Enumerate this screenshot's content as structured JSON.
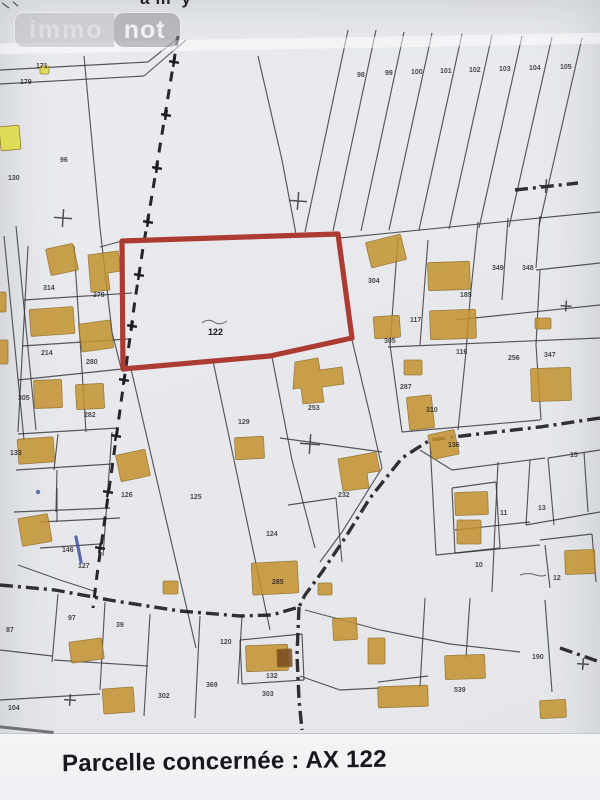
{
  "watermark": {
    "left": "immo",
    "right": "not"
  },
  "top_edge_fragments": [
    "am",
    "y"
  ],
  "caption": {
    "text": "Parcelle concernée : AX 122"
  },
  "colors": {
    "paper": "#e9ebee",
    "band": "#f3f4f5",
    "caption_color": "#17181c",
    "line": "#33343a",
    "road": "#1b1b1f",
    "building": "#c3922e",
    "building_edge": "#8f6a1d",
    "lemon": "#e0dc3f",
    "dark_building": "#7a4a1e",
    "red": "#ac3a31",
    "blue_ink": "#3f51a3"
  },
  "map": {
    "red_parcel_points": "122,241 338,234 352,338 270,356 123,369",
    "red_parcel_label": {
      "t": "122",
      "x": 208,
      "y": 335
    },
    "labels": [
      {
        "t": "171",
        "x": 36,
        "y": 68
      },
      {
        "t": "179",
        "x": 20,
        "y": 84
      },
      {
        "t": "96",
        "x": 60,
        "y": 162
      },
      {
        "t": "130",
        "x": 8,
        "y": 180
      },
      {
        "t": "98",
        "x": 357,
        "y": 77
      },
      {
        "t": "99",
        "x": 385,
        "y": 75
      },
      {
        "t": "100",
        "x": 411,
        "y": 74
      },
      {
        "t": "101",
        "x": 440,
        "y": 73
      },
      {
        "t": "102",
        "x": 469,
        "y": 72
      },
      {
        "t": "103",
        "x": 499,
        "y": 71
      },
      {
        "t": "104",
        "x": 529,
        "y": 70
      },
      {
        "t": "105",
        "x": 560,
        "y": 69
      },
      {
        "t": "304",
        "x": 368,
        "y": 283
      },
      {
        "t": "185",
        "x": 460,
        "y": 297
      },
      {
        "t": "349",
        "x": 492,
        "y": 270
      },
      {
        "t": "348",
        "x": 522,
        "y": 270
      },
      {
        "t": "117",
        "x": 410,
        "y": 322
      },
      {
        "t": "305",
        "x": 384,
        "y": 343
      },
      {
        "t": "116",
        "x": 456,
        "y": 354
      },
      {
        "t": "256",
        "x": 508,
        "y": 360
      },
      {
        "t": "347",
        "x": 544,
        "y": 357
      },
      {
        "t": "287",
        "x": 400,
        "y": 389
      },
      {
        "t": "310",
        "x": 426,
        "y": 412
      },
      {
        "t": "136",
        "x": 448,
        "y": 447
      },
      {
        "t": "314",
        "x": 43,
        "y": 290
      },
      {
        "t": "279",
        "x": 93,
        "y": 297
      },
      {
        "t": "214",
        "x": 41,
        "y": 355
      },
      {
        "t": "280",
        "x": 86,
        "y": 364
      },
      {
        "t": "305",
        "x": 18,
        "y": 400
      },
      {
        "t": "282",
        "x": 84,
        "y": 417
      },
      {
        "t": "133",
        "x": 10,
        "y": 455
      },
      {
        "t": "126",
        "x": 121,
        "y": 497
      },
      {
        "t": "125",
        "x": 190,
        "y": 499
      },
      {
        "t": "129",
        "x": 238,
        "y": 424
      },
      {
        "t": "124",
        "x": 266,
        "y": 536
      },
      {
        "t": "253",
        "x": 308,
        "y": 410
      },
      {
        "t": "232",
        "x": 338,
        "y": 497
      },
      {
        "t": "146",
        "x": 62,
        "y": 552
      },
      {
        "t": "127",
        "x": 78,
        "y": 568
      },
      {
        "t": "97",
        "x": 68,
        "y": 620
      },
      {
        "t": "39",
        "x": 116,
        "y": 627
      },
      {
        "t": "87",
        "x": 6,
        "y": 632
      },
      {
        "t": "104",
        "x": 8,
        "y": 710
      },
      {
        "t": "120",
        "x": 220,
        "y": 644
      },
      {
        "t": "285",
        "x": 272,
        "y": 584
      },
      {
        "t": "369",
        "x": 206,
        "y": 687
      },
      {
        "t": "302",
        "x": 158,
        "y": 698
      },
      {
        "t": "132",
        "x": 266,
        "y": 678
      },
      {
        "t": "303",
        "x": 262,
        "y": 696
      },
      {
        "t": "190",
        "x": 532,
        "y": 659
      },
      {
        "t": "539",
        "x": 454,
        "y": 692
      },
      {
        "t": "15",
        "x": 570,
        "y": 457
      },
      {
        "t": "13",
        "x": 538,
        "y": 510
      },
      {
        "t": "11",
        "x": 500,
        "y": 515
      },
      {
        "t": "10",
        "x": 475,
        "y": 567
      },
      {
        "t": "12",
        "x": 553,
        "y": 580
      }
    ],
    "buildings": [
      {
        "x": 0,
        "y": 126,
        "w": 20,
        "h": 24,
        "r": -5,
        "c": "lemon"
      },
      {
        "x": 40,
        "y": 66,
        "w": 9,
        "h": 8,
        "r": 0,
        "c": "lemon"
      },
      {
        "x": 48,
        "y": 246,
        "w": 28,
        "h": 27,
        "r": -12
      },
      {
        "p": "88,255 118,251 121,271 108,273 110,290 91,292"
      },
      {
        "x": 368,
        "y": 238,
        "w": 36,
        "h": 26,
        "r": -14
      },
      {
        "x": 428,
        "y": 262,
        "w": 42,
        "h": 28,
        "r": -2
      },
      {
        "x": 30,
        "y": 308,
        "w": 44,
        "h": 27,
        "r": -4
      },
      {
        "x": 80,
        "y": 322,
        "w": 32,
        "h": 28,
        "r": -8
      },
      {
        "x": 374,
        "y": 316,
        "w": 26,
        "h": 22,
        "r": -4
      },
      {
        "x": 430,
        "y": 310,
        "w": 46,
        "h": 29,
        "r": -2
      },
      {
        "x": 535,
        "y": 318,
        "w": 16,
        "h": 11,
        "r": 0
      },
      {
        "x": 34,
        "y": 380,
        "w": 28,
        "h": 28,
        "r": -2
      },
      {
        "x": 76,
        "y": 384,
        "w": 28,
        "h": 25,
        "r": -3
      },
      {
        "x": 531,
        "y": 368,
        "w": 40,
        "h": 33,
        "r": -2
      },
      {
        "p": "295,362 318,358 320,370 342,367 344,384 322,387 324,402 303,404 301,388 293,389"
      },
      {
        "x": 404,
        "y": 360,
        "w": 18,
        "h": 15,
        "r": 0
      },
      {
        "x": 408,
        "y": 396,
        "w": 25,
        "h": 33,
        "r": -6
      },
      {
        "x": 430,
        "y": 432,
        "w": 27,
        "h": 25,
        "r": -12
      },
      {
        "x": 118,
        "y": 452,
        "w": 30,
        "h": 27,
        "r": -12
      },
      {
        "x": 18,
        "y": 438,
        "w": 36,
        "h": 25,
        "r": -4
      },
      {
        "x": 20,
        "y": 516,
        "w": 30,
        "h": 28,
        "r": -10
      },
      {
        "x": 235,
        "y": 437,
        "w": 29,
        "h": 22,
        "r": -3
      },
      {
        "p": "338,459 376,452 380,471 367,473 369,488 343,491"
      },
      {
        "x": 455,
        "y": 492,
        "w": 33,
        "h": 23,
        "r": -2
      },
      {
        "x": 457,
        "y": 520,
        "w": 24,
        "h": 24,
        "r": 0
      },
      {
        "x": 565,
        "y": 550,
        "w": 30,
        "h": 24,
        "r": -2
      },
      {
        "x": 70,
        "y": 640,
        "w": 33,
        "h": 21,
        "r": -8
      },
      {
        "x": 103,
        "y": 688,
        "w": 31,
        "h": 25,
        "r": -4
      },
      {
        "x": 246,
        "y": 645,
        "w": 42,
        "h": 26,
        "r": -2
      },
      {
        "x": 277,
        "y": 649,
        "w": 15,
        "h": 18,
        "r": -2,
        "c": "dark"
      },
      {
        "x": 163,
        "y": 581,
        "w": 15,
        "h": 13,
        "r": 0
      },
      {
        "x": 318,
        "y": 583,
        "w": 14,
        "h": 12,
        "r": 0
      },
      {
        "x": 252,
        "y": 562,
        "w": 46,
        "h": 32,
        "r": -3
      },
      {
        "x": 333,
        "y": 618,
        "w": 24,
        "h": 22,
        "r": -3
      },
      {
        "x": 368,
        "y": 638,
        "w": 17,
        "h": 26,
        "r": 0
      },
      {
        "x": 378,
        "y": 686,
        "w": 50,
        "h": 21,
        "r": -2
      },
      {
        "x": 445,
        "y": 655,
        "w": 40,
        "h": 24,
        "r": -2
      },
      {
        "x": 540,
        "y": 700,
        "w": 26,
        "h": 18,
        "r": -3
      },
      {
        "x": -6,
        "y": 340,
        "w": 14,
        "h": 24,
        "r": 0
      },
      {
        "x": -6,
        "y": 292,
        "w": 12,
        "h": 20,
        "r": 0
      }
    ],
    "lines": [
      [
        2,
        3,
        9,
        8
      ],
      [
        13,
        2,
        18,
        6
      ],
      [
        0,
        70,
        148,
        62
      ],
      [
        0,
        84,
        144,
        76
      ],
      [
        144,
        76,
        186,
        40
      ],
      [
        148,
        62,
        178,
        38
      ],
      [
        84,
        56,
        100,
        228,
        112,
        332,
        121,
        368
      ],
      [
        258,
        56,
        282,
        160,
        296,
        234
      ],
      [
        16,
        226,
        36,
        430
      ],
      [
        4,
        236,
        24,
        440
      ],
      [
        100,
        247,
        122,
        241
      ],
      [
        24,
        300,
        132,
        293
      ],
      [
        22,
        346,
        128,
        339
      ],
      [
        18,
        380,
        122,
        369
      ],
      [
        18,
        434,
        118,
        428
      ],
      [
        74,
        246,
        86,
        432
      ],
      [
        28,
        246,
        18,
        432
      ],
      [
        16,
        470,
        112,
        464
      ],
      [
        58,
        434,
        54,
        470
      ],
      [
        14,
        512,
        110,
        508
      ],
      [
        57,
        470,
        56,
        512
      ],
      [
        40,
        522,
        120,
        518
      ],
      [
        57,
        488,
        57,
        522
      ],
      [
        18,
        565,
        60,
        580,
        97,
        592
      ],
      [
        40,
        548,
        100,
        544
      ],
      [
        112,
        432,
        103,
        556
      ],
      [
        131,
        369,
        196,
        648
      ],
      [
        213,
        361,
        270,
        630
      ],
      [
        272,
        357,
        292,
        460,
        315,
        548
      ],
      [
        352,
        340,
        370,
        415,
        382,
        468
      ],
      [
        280,
        438,
        382,
        452
      ],
      [
        288,
        505,
        336,
        498
      ],
      [
        336,
        498,
        342,
        562
      ],
      [
        382,
        468,
        342,
        532,
        320,
        562
      ],
      [
        398,
        238,
        390,
        345,
        402,
        432
      ],
      [
        428,
        240,
        420,
        345
      ],
      [
        478,
        222,
        470,
        300,
        466,
        352
      ],
      [
        508,
        218,
        502,
        300
      ],
      [
        540,
        216,
        536,
        268
      ],
      [
        455,
        320,
        600,
        305
      ],
      [
        388,
        347,
        600,
        338
      ],
      [
        402,
        432,
        540,
        420
      ],
      [
        466,
        352,
        458,
        430
      ],
      [
        540,
        270,
        536,
        345,
        541,
        420
      ],
      [
        536,
        270,
        600,
        263
      ],
      [
        452,
        470,
        545,
        458
      ],
      [
        548,
        458,
        600,
        450
      ],
      [
        498,
        462,
        492,
        592
      ],
      [
        530,
        460,
        526,
        525
      ],
      [
        548,
        458,
        554,
        525
      ],
      [
        455,
        530,
        530,
        522
      ],
      [
        526,
        525,
        600,
        512
      ],
      [
        584,
        452,
        588,
        512
      ],
      [
        540,
        540,
        592,
        534
      ],
      [
        592,
        534,
        596,
        582
      ],
      [
        545,
        545,
        550,
        588
      ],
      [
        420,
        450,
        452,
        470
      ],
      [
        452,
        488,
        496,
        482
      ],
      [
        496,
        482,
        500,
        548
      ],
      [
        452,
        488,
        455,
        553
      ],
      [
        455,
        553,
        500,
        548
      ],
      [
        150,
        614,
        144,
        716
      ],
      [
        200,
        616,
        195,
        718
      ],
      [
        242,
        616,
        238,
        684
      ],
      [
        240,
        640,
        302,
        634
      ],
      [
        302,
        634,
        304,
        680
      ],
      [
        240,
        640,
        242,
        684
      ],
      [
        242,
        684,
        304,
        680
      ],
      [
        58,
        594,
        52,
        662
      ],
      [
        0,
        650,
        52,
        656
      ],
      [
        54,
        660,
        148,
        666
      ],
      [
        105,
        602,
        100,
        690
      ],
      [
        0,
        700,
        100,
        694
      ],
      [
        430,
        442,
        436,
        555
      ],
      [
        436,
        555,
        540,
        545
      ],
      [
        425,
        598,
        420,
        688
      ],
      [
        378,
        682,
        428,
        676
      ],
      [
        300,
        676,
        340,
        690,
        380,
        688
      ],
      [
        545,
        600,
        552,
        692
      ],
      [
        470,
        598,
        466,
        658
      ],
      [
        340,
        238,
        600,
        212
      ],
      [
        305,
        610,
        380,
        630,
        450,
        644,
        520,
        652
      ],
      [
        348,
        30,
        305,
        232
      ],
      [
        376,
        30,
        333,
        231
      ],
      [
        404,
        32,
        361,
        231
      ],
      [
        432,
        33,
        389,
        230
      ],
      [
        462,
        34,
        419,
        230
      ],
      [
        492,
        35,
        449,
        229
      ],
      [
        522,
        36,
        479,
        228
      ],
      [
        552,
        37,
        509,
        227
      ],
      [
        582,
        38,
        539,
        226
      ]
    ],
    "roads": [
      [
        600,
        418,
        540,
        427,
        470,
        435,
        430,
        440,
        402,
        458,
        370,
        498,
        345,
        538,
        322,
        572,
        305,
        595,
        299,
        607
      ],
      [
        0,
        585,
        55,
        590,
        115,
        601,
        180,
        611,
        240,
        616,
        272,
        615,
        299,
        607
      ],
      [
        299,
        607,
        297,
        655,
        299,
        700,
        302,
        730
      ],
      [
        560,
        648,
        600,
        662
      ],
      [
        515,
        190,
        578,
        183
      ]
    ],
    "dashed_path": {
      "points": [
        178,
        36,
        170,
        85,
        161,
        140,
        152,
        195,
        143,
        248,
        135,
        300,
        128,
        352,
        120,
        410,
        112,
        468,
        104,
        525,
        97,
        575,
        93,
        608
      ],
      "plus": [
        [
          174,
          62
        ],
        [
          166,
          115
        ],
        [
          157,
          168
        ],
        [
          148,
          222
        ],
        [
          139,
          275
        ],
        [
          132,
          326
        ],
        [
          124,
          380
        ],
        [
          116,
          436
        ],
        [
          108,
          492
        ],
        [
          100,
          548
        ]
      ]
    },
    "crosses": [
      [
        63,
        218,
        18
      ],
      [
        298,
        201,
        18
      ],
      [
        310,
        444,
        20
      ],
      [
        566,
        306,
        11
      ],
      [
        583,
        664,
        12
      ],
      [
        70,
        700,
        12
      ],
      [
        546,
        186,
        14
      ]
    ],
    "scribbles": [
      "M202,323 q6,-5 12,-1 q6,4 13,-1",
      "M520,575 q8,-3 16,0 q6,2 10,0"
    ],
    "blue_mark": {
      "line": [
        76,
        537,
        81,
        562
      ],
      "dot": [
        38,
        492,
        2.2
      ]
    }
  }
}
